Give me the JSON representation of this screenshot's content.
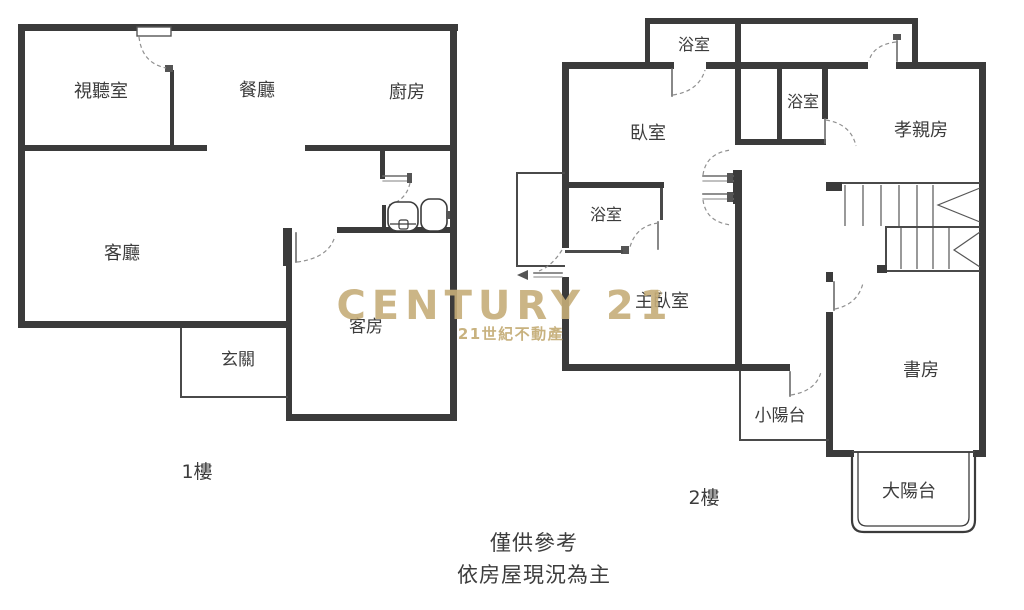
{
  "colors": {
    "wall": "#3b3b3b",
    "thin": "#4a4a4a",
    "text": "#3c3c3c"
  },
  "watermark": {
    "brand": "CENTURY 21",
    "registered": "®",
    "subtitle": "21世紀不動產",
    "color": "#c6ae79"
  },
  "disclaimer": {
    "line1": "僅供參考",
    "line2": "依房屋現況為主"
  },
  "floor1": {
    "label": "1樓",
    "rooms": {
      "av_room": "視聽室",
      "dining_room": "餐廳",
      "kitchen": "廚房",
      "living_room": "客廳",
      "guest_room": "客房",
      "foyer": "玄關"
    }
  },
  "floor2": {
    "label": "2樓",
    "rooms": {
      "bathroom_top": "浴室",
      "bedroom": "臥室",
      "bathroom_middle": "浴室",
      "parents_room": "孝親房",
      "bathroom_master": "浴室",
      "master_bedroom": "主臥室",
      "study": "書房",
      "small_balcony": "小陽台",
      "large_balcony": "大陽台"
    }
  }
}
